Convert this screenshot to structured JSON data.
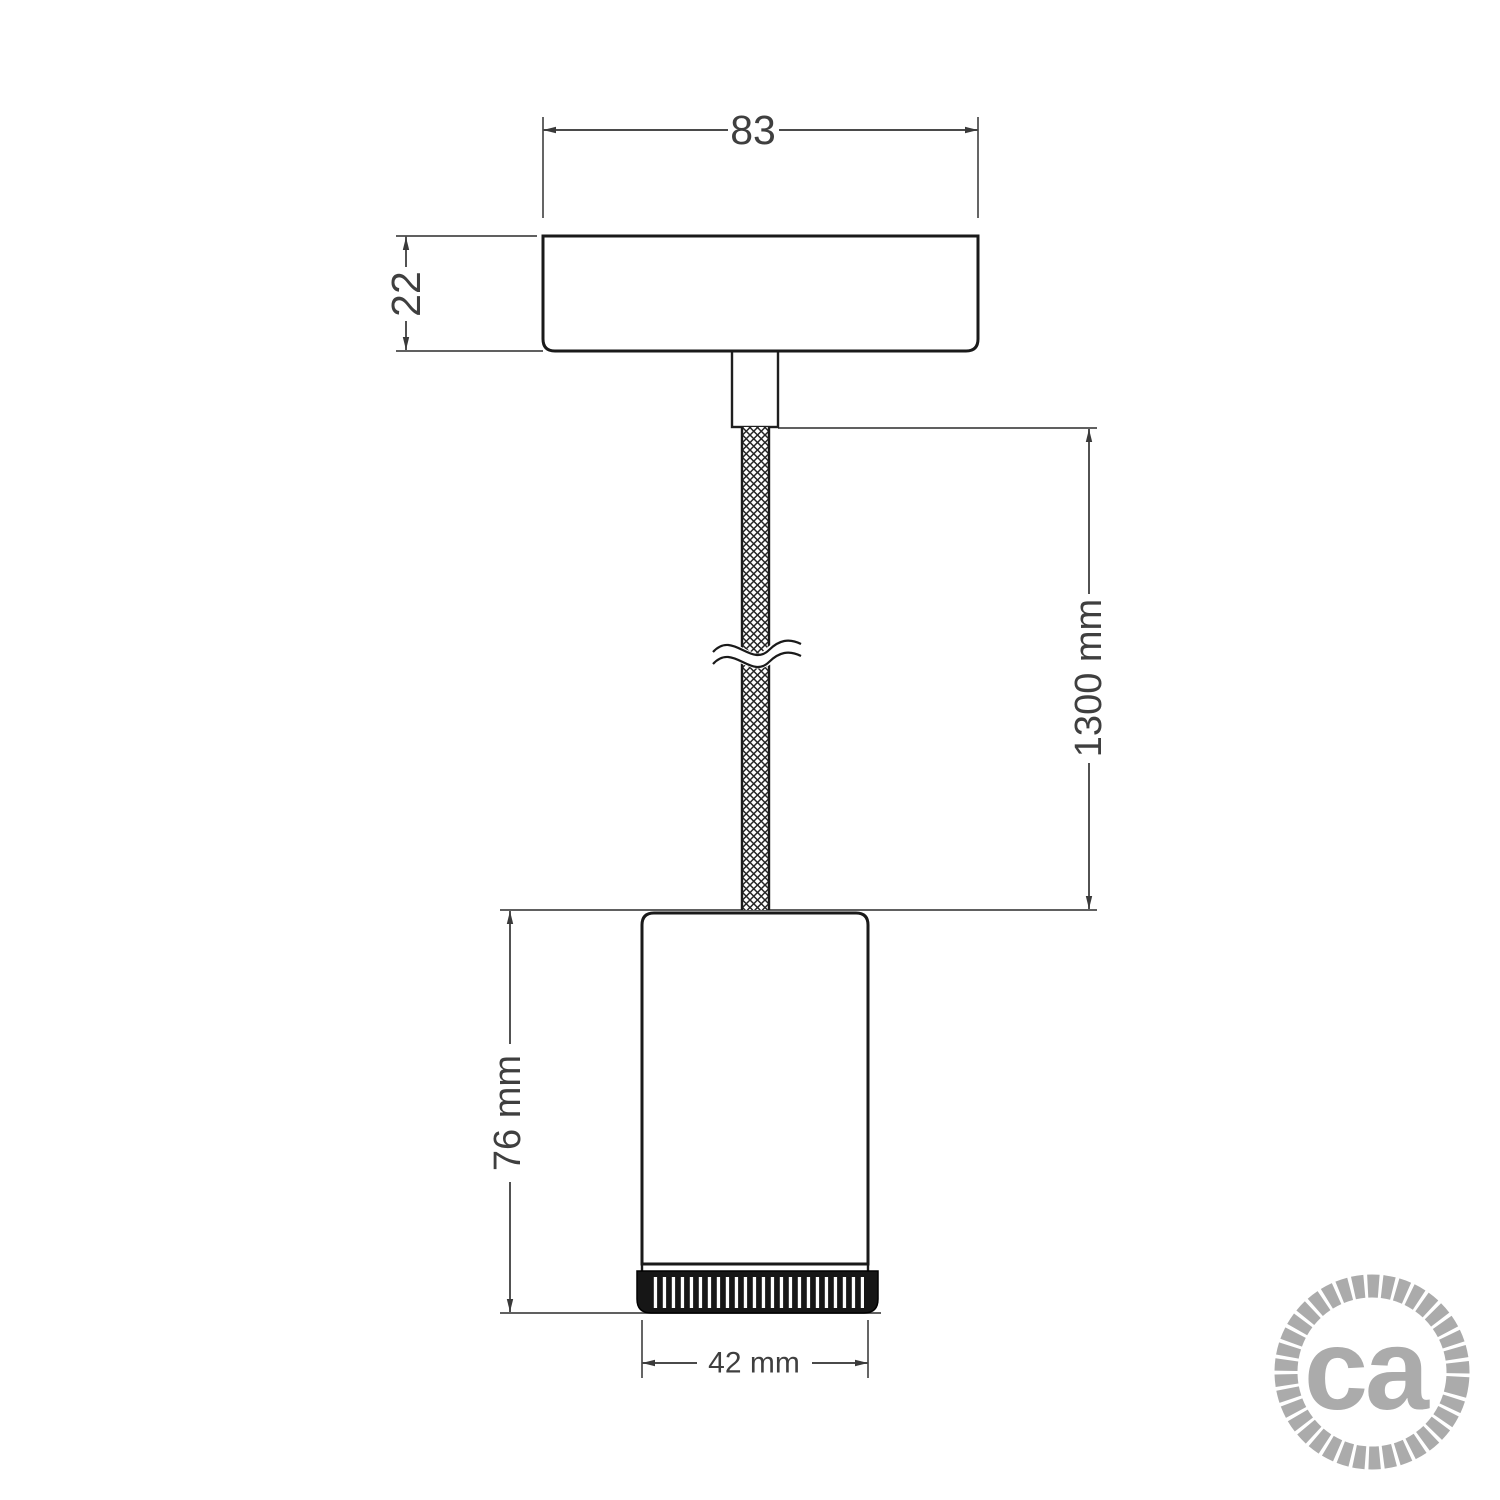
{
  "meta": {
    "title": "Pendant spotlight dimensional drawing"
  },
  "dimensions": {
    "canopy_width": "83",
    "canopy_height": "22",
    "cable_length": "1300 mm",
    "spotlight_height": "76 mm",
    "spotlight_diameter": "42 mm"
  },
  "logo": {
    "text": "ca"
  },
  "colors": {
    "outline": "#1a1a1a",
    "dimension_line": "#4a4a4a",
    "dimension_text": "#3f3f3f",
    "knurl_fill": "#161616",
    "logo_gray": "#ababab",
    "background": "#ffffff"
  }
}
